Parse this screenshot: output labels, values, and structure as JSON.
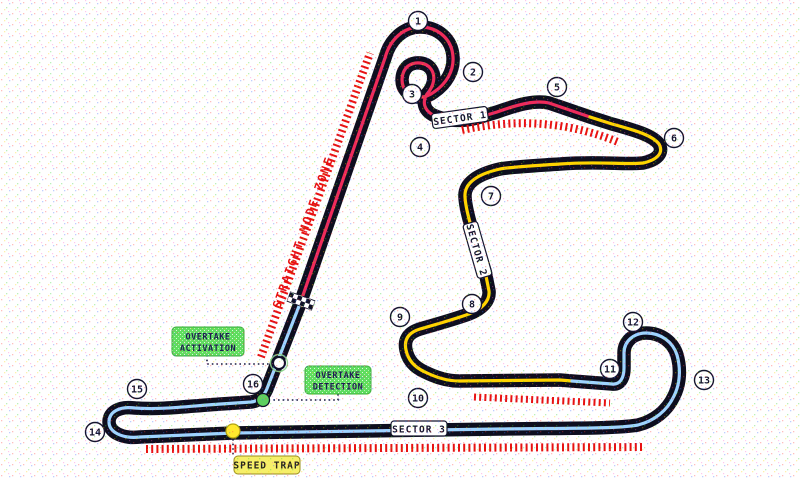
{
  "map": {
    "type_label": "race-circuit-map"
  },
  "colors": {
    "track": "#0e0e1e",
    "sector1": "#ee2b5b",
    "sector2": "#ffd400",
    "sector3": "#9fd4ff",
    "zone_dashes": "#e81212",
    "zone_text": "#e81212",
    "green_box": "#5fdd5f",
    "yellow_box": "#f6ef69",
    "detection_point": "#5ecf5e",
    "speed_trap_point": "#ffe92e"
  },
  "sectors": [
    {
      "label": "SECTOR 1"
    },
    {
      "label": "SECTOR 2"
    },
    {
      "label": "SECTOR 3"
    }
  ],
  "labels": {
    "straight_mode_zone": "STRAIGHT MODE ZONE",
    "overtake_activation": {
      "line1": "OVERTAKE",
      "line2": "ACTIVATION"
    },
    "overtake_detection": {
      "line1": "OVERTAKE",
      "line2": "DETECTION"
    },
    "speed_trap": "SPEED TRAP"
  },
  "turns": [
    {
      "n": "1",
      "x": 418,
      "y": 21
    },
    {
      "n": "2",
      "x": 473,
      "y": 72
    },
    {
      "n": "3",
      "x": 412,
      "y": 94
    },
    {
      "n": "4",
      "x": 420,
      "y": 147
    },
    {
      "n": "5",
      "x": 557,
      "y": 87
    },
    {
      "n": "6",
      "x": 674,
      "y": 138
    },
    {
      "n": "7",
      "x": 491,
      "y": 196
    },
    {
      "n": "8",
      "x": 472,
      "y": 304
    },
    {
      "n": "9",
      "x": 400,
      "y": 317
    },
    {
      "n": "10",
      "x": 418,
      "y": 398
    },
    {
      "n": "11",
      "x": 610,
      "y": 369
    },
    {
      "n": "12",
      "x": 633,
      "y": 322
    },
    {
      "n": "13",
      "x": 704,
      "y": 380
    },
    {
      "n": "14",
      "x": 95,
      "y": 432
    },
    {
      "n": "15",
      "x": 137,
      "y": 389
    },
    {
      "n": "16",
      "x": 253,
      "y": 384
    }
  ]
}
